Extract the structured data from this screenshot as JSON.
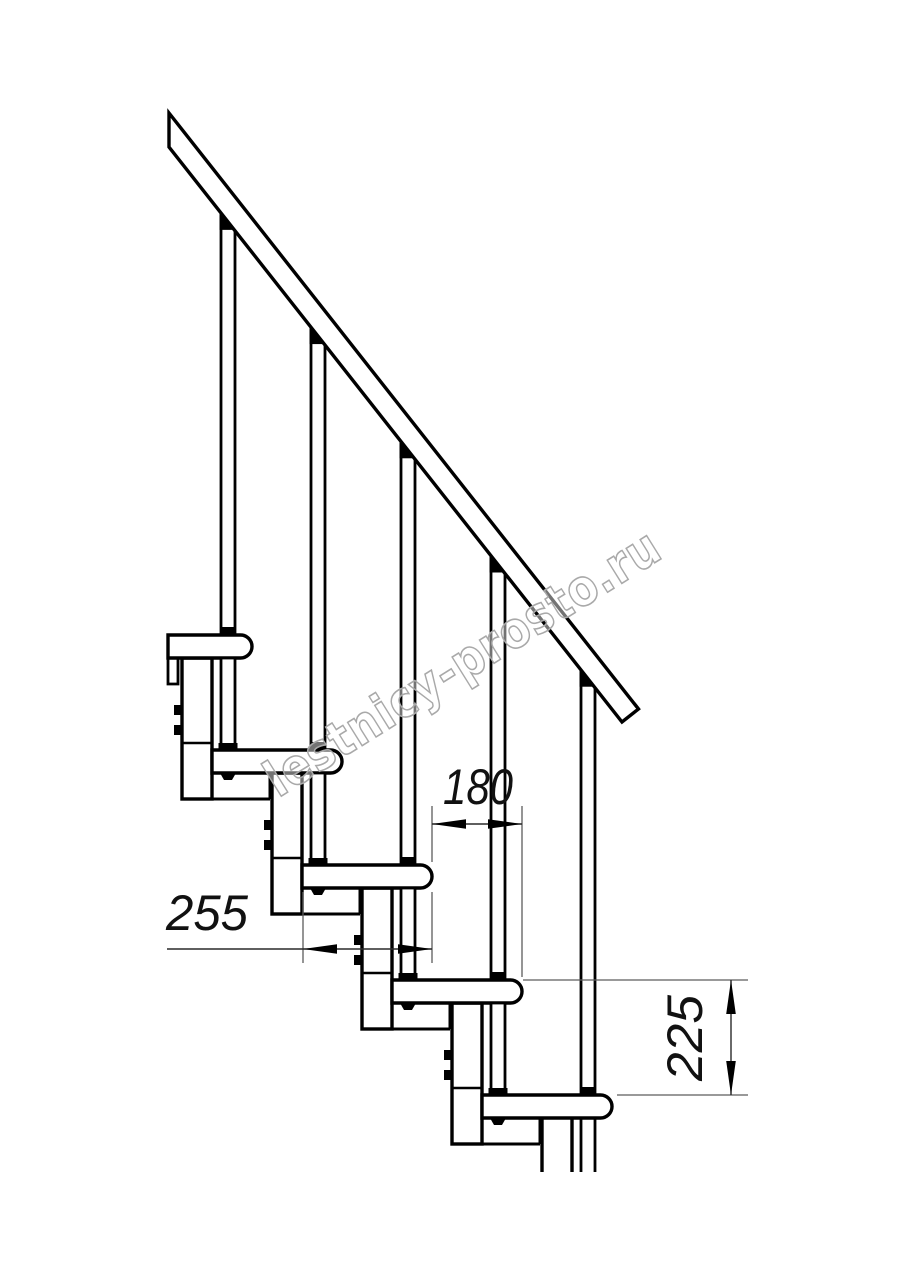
{
  "page": {
    "background": "#ffffff"
  },
  "drawing": {
    "type": "staircase-side-view-technical-drawing",
    "steps_visible": 5,
    "scale_px_per_mm": 0.5,
    "line_color": "#000000",
    "dim_line_color": "#2a2a2a",
    "ext_line_color": "#5c5c5c",
    "fill_color": "#ffffff"
  },
  "dims": {
    "run": {
      "label": "180"
    },
    "depth": {
      "label": "255"
    },
    "rise": {
      "label": "225"
    }
  },
  "watermark": {
    "text": "lestnicy-prosto.ru",
    "color": "#a9a9a9"
  }
}
